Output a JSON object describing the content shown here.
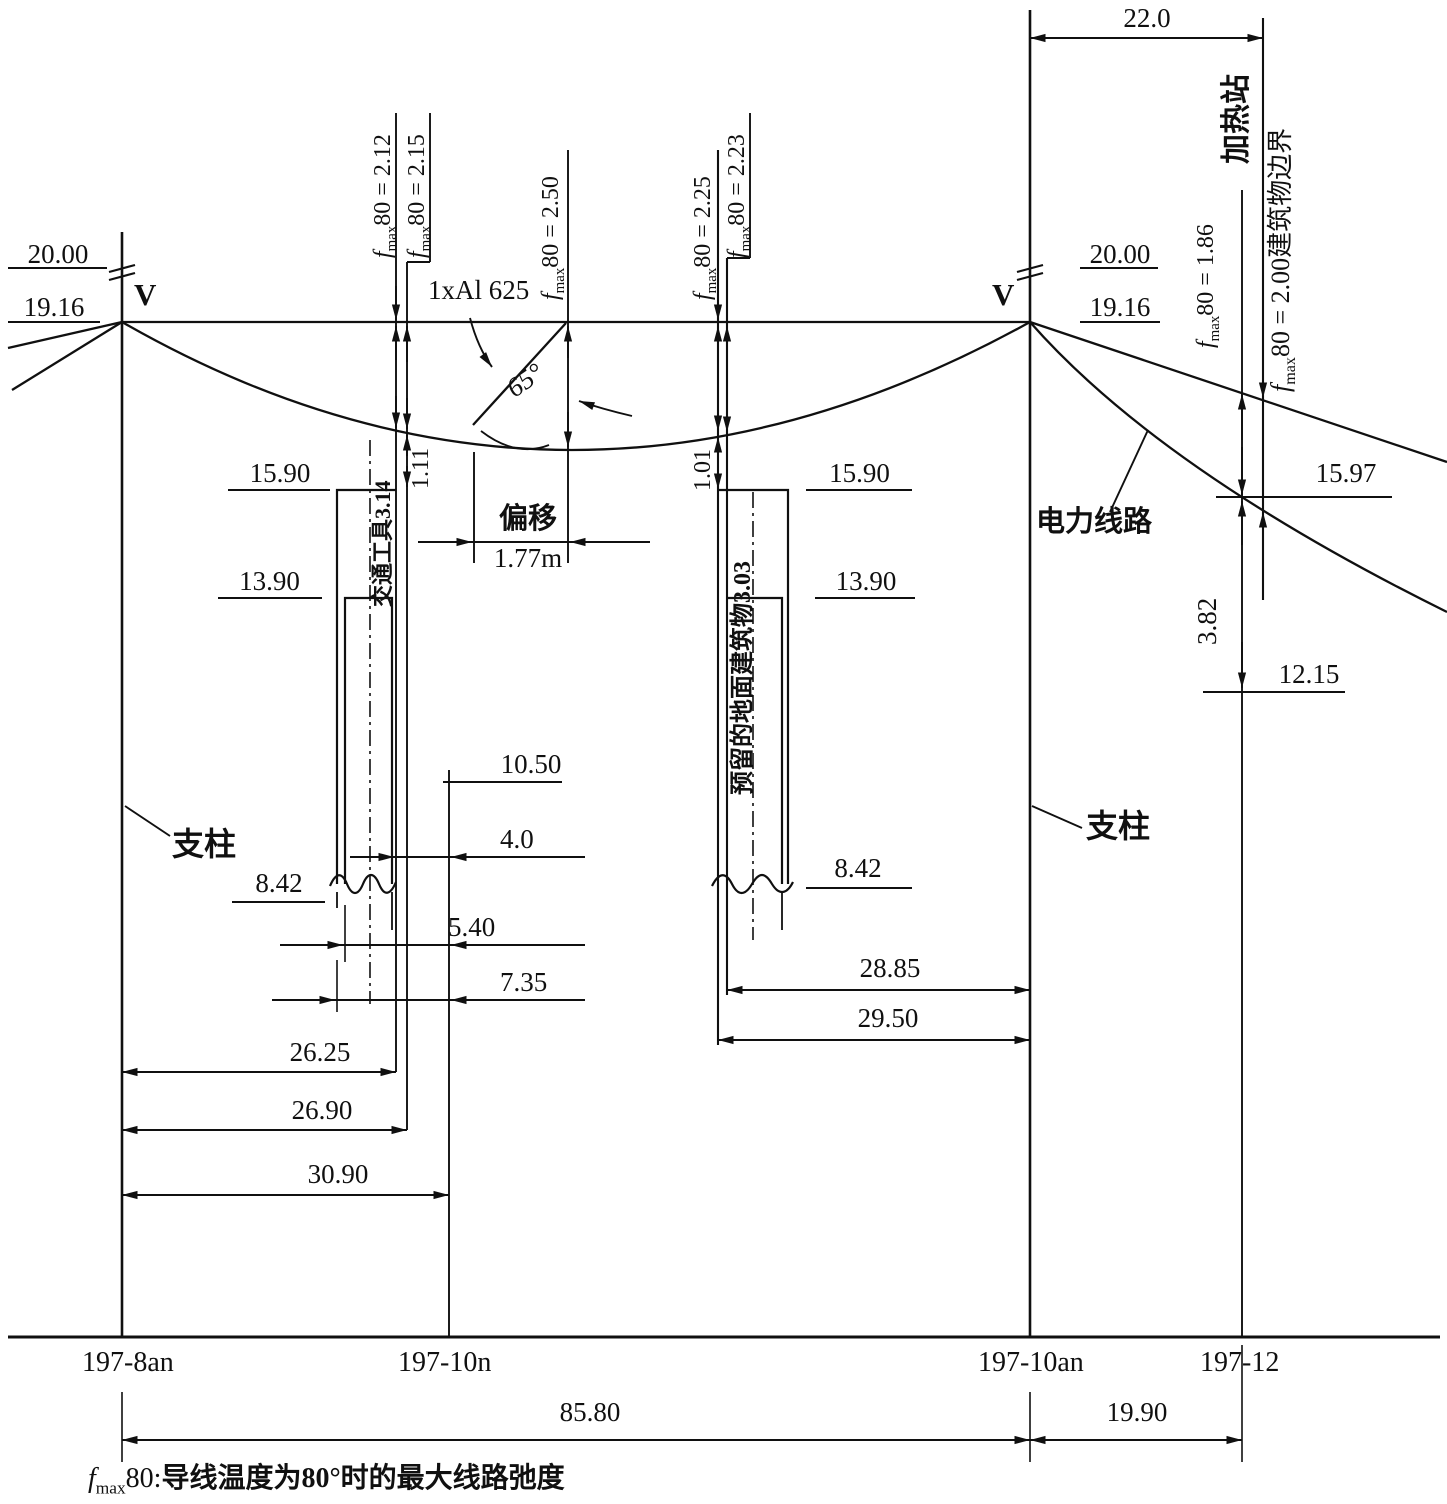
{
  "t": {
    "f": "f",
    "fsub": "max",
    "elev_20_left": "20.00",
    "elev_1916_left": "19.16",
    "v_left": "V",
    "v_right": "V",
    "elev_20_right": "20.00",
    "elev_1916_right": "19.16",
    "dim_22": "22.0",
    "heating_station": "加热站",
    "f212": "80 = 2.12",
    "f215": "80 = 2.15",
    "f250": "80 = 2.50",
    "f225": "80 = 2.25",
    "f223": "80 = 2.23",
    "f186": "80 = 1.86",
    "f200_boundary": "80 = 2.00建筑物边界",
    "conductor": "1xAl 625",
    "angle": "65°",
    "elev_1590_left": "15.90",
    "elev_1390_left": "13.90",
    "elev_1590_right": "15.90",
    "elev_1390_right": "13.90",
    "clearance_111": "1.11",
    "clearance_101": "1.01",
    "vehicle": "交通工具3.14",
    "reserved_building": "预留的地面建筑物3.03",
    "offset_label": "偏移",
    "offset_value": "1.77m",
    "elev_1050": "10.50",
    "dim_40": "4.0",
    "elev_842_left": "8.42",
    "elev_842_right": "8.42",
    "dim_540": "5.40",
    "dim_735": "7.35",
    "dim_2625": "26.25",
    "dim_2690": "26.90",
    "dim_3090": "30.90",
    "dim_2885": "28.85",
    "dim_2950": "29.50",
    "power_line": "电力线路",
    "elev_1597": "15.97",
    "dim_382": "3.82",
    "elev_1215": "12.15",
    "support_left": "支柱",
    "support_right": "支柱",
    "pole_197_8an": "197-8an",
    "pole_197_10n": "197-10n",
    "pole_197_10an": "197-10an",
    "pole_197_12": "197-12",
    "dim_8580": "85.80",
    "dim_1990": "19.90",
    "note_80": "80:",
    "note_text": "导线温度为80°时的最大线路弛度"
  }
}
